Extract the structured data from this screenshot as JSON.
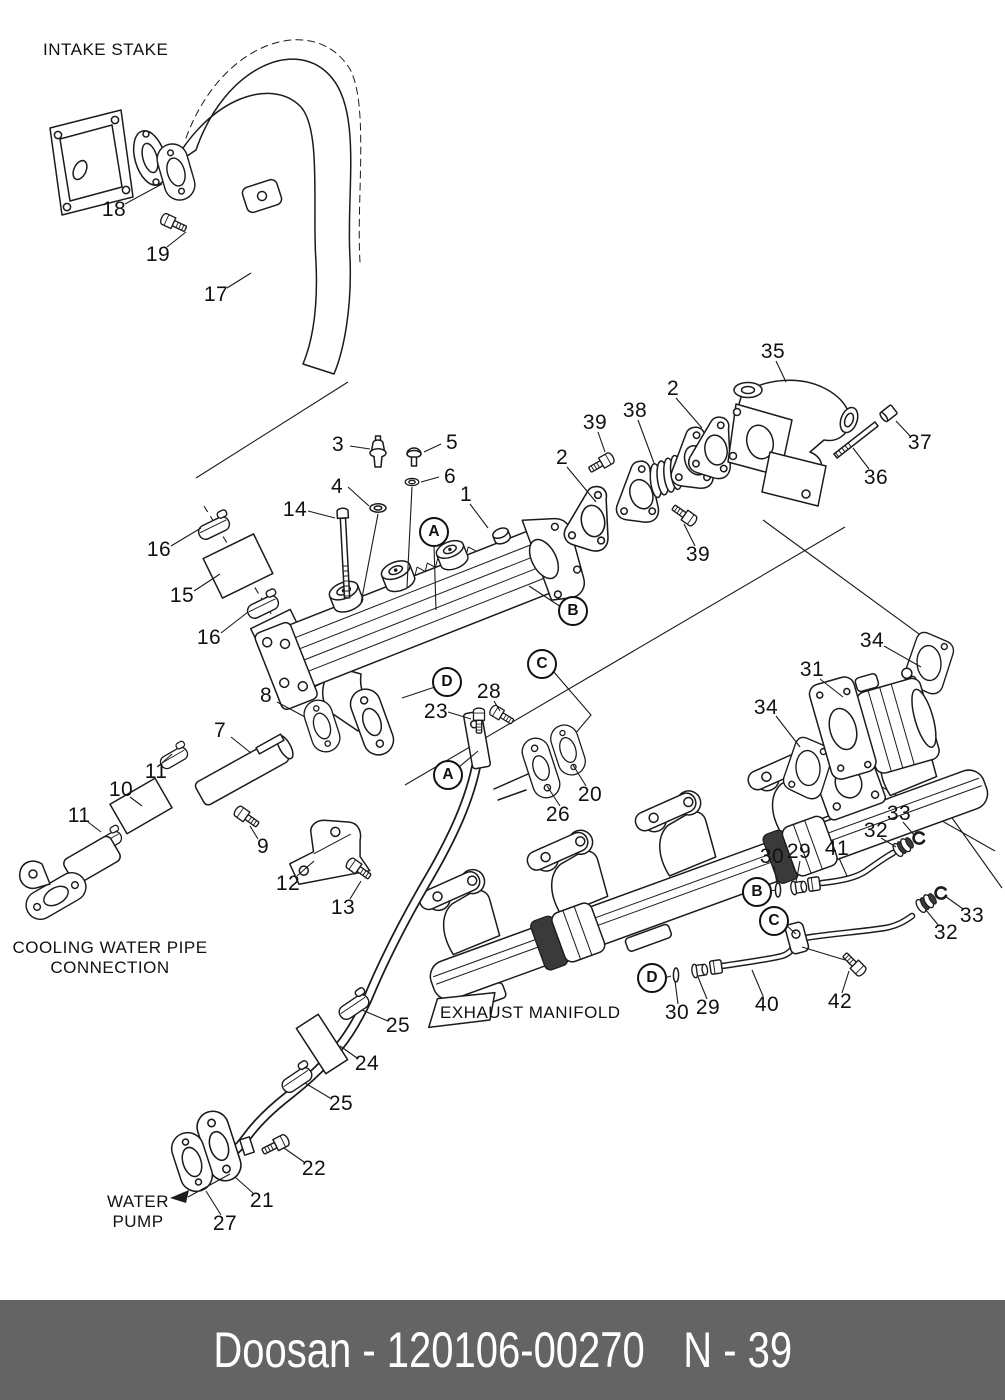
{
  "colors": {
    "background": "#ffffff",
    "line": "#1b1b1b",
    "footer_background": "#646464",
    "footer_text": "#ffffff"
  },
  "diagram": {
    "section_labels": [
      {
        "id": "intake-stake",
        "lines": [
          "INTAKE STAKE"
        ],
        "x": 43,
        "y": 40,
        "align": "left"
      },
      {
        "id": "cooling-water-pipe-connection",
        "lines": [
          "COOLING WATER PIPE",
          "CONNECTION"
        ],
        "x": 110,
        "y": 938,
        "align": "center"
      },
      {
        "id": "exhaust-manifold",
        "lines": [
          "EXHAUST MANIFOLD"
        ],
        "x": 440,
        "y": 1003,
        "align": "left"
      },
      {
        "id": "water-pump",
        "lines": [
          "WATER",
          "PUMP"
        ],
        "x": 138,
        "y": 1192,
        "align": "center"
      }
    ],
    "callouts": [
      {
        "label": "18",
        "x": 114,
        "y": 210,
        "shape": "plain"
      },
      {
        "label": "19",
        "x": 158,
        "y": 255,
        "shape": "plain"
      },
      {
        "label": "17",
        "x": 216,
        "y": 295,
        "shape": "plain"
      },
      {
        "label": "3",
        "x": 338,
        "y": 445,
        "shape": "plain"
      },
      {
        "label": "5",
        "x": 452,
        "y": 443,
        "shape": "plain"
      },
      {
        "label": "4",
        "x": 337,
        "y": 487,
        "shape": "plain"
      },
      {
        "label": "6",
        "x": 450,
        "y": 477,
        "shape": "plain"
      },
      {
        "label": "1",
        "x": 466,
        "y": 495,
        "shape": "plain"
      },
      {
        "label": "14",
        "x": 295,
        "y": 510,
        "shape": "plain"
      },
      {
        "label": "2",
        "x": 562,
        "y": 458,
        "shape": "plain"
      },
      {
        "label": "39",
        "x": 595,
        "y": 423,
        "shape": "plain"
      },
      {
        "label": "38",
        "x": 635,
        "y": 411,
        "shape": "plain"
      },
      {
        "label": "2",
        "x": 673,
        "y": 389,
        "shape": "plain"
      },
      {
        "label": "35",
        "x": 773,
        "y": 352,
        "shape": "plain"
      },
      {
        "label": "37",
        "x": 920,
        "y": 443,
        "shape": "plain"
      },
      {
        "label": "36",
        "x": 876,
        "y": 478,
        "shape": "plain"
      },
      {
        "label": "39",
        "x": 698,
        "y": 555,
        "shape": "plain"
      },
      {
        "label": "16",
        "x": 159,
        "y": 550,
        "shape": "plain"
      },
      {
        "label": "15",
        "x": 182,
        "y": 596,
        "shape": "plain"
      },
      {
        "label": "16",
        "x": 209,
        "y": 638,
        "shape": "plain"
      },
      {
        "label": "A",
        "x": 434,
        "y": 532,
        "shape": "circled"
      },
      {
        "label": "B",
        "x": 573,
        "y": 611,
        "shape": "circled"
      },
      {
        "label": "C",
        "x": 542,
        "y": 664,
        "shape": "circled"
      },
      {
        "label": "D",
        "x": 447,
        "y": 682,
        "shape": "circled"
      },
      {
        "label": "34",
        "x": 872,
        "y": 641,
        "shape": "plain"
      },
      {
        "label": "31",
        "x": 812,
        "y": 670,
        "shape": "plain"
      },
      {
        "label": "34",
        "x": 766,
        "y": 708,
        "shape": "plain"
      },
      {
        "label": "8",
        "x": 266,
        "y": 696,
        "shape": "plain"
      },
      {
        "label": "23",
        "x": 436,
        "y": 712,
        "shape": "plain"
      },
      {
        "label": "28",
        "x": 489,
        "y": 692,
        "shape": "plain"
      },
      {
        "label": "7",
        "x": 220,
        "y": 731,
        "shape": "plain"
      },
      {
        "label": "A",
        "x": 448,
        "y": 775,
        "shape": "circled"
      },
      {
        "label": "26",
        "x": 558,
        "y": 815,
        "shape": "plain"
      },
      {
        "label": "20",
        "x": 590,
        "y": 795,
        "shape": "plain"
      },
      {
        "label": "11",
        "x": 156,
        "y": 772,
        "shape": "plain"
      },
      {
        "label": "10",
        "x": 121,
        "y": 790,
        "shape": "plain"
      },
      {
        "label": "11",
        "x": 79,
        "y": 816,
        "shape": "plain"
      },
      {
        "label": "9",
        "x": 263,
        "y": 847,
        "shape": "plain"
      },
      {
        "label": "12",
        "x": 288,
        "y": 884,
        "shape": "plain"
      },
      {
        "label": "13",
        "x": 343,
        "y": 908,
        "shape": "plain"
      },
      {
        "label": "33",
        "x": 899,
        "y": 814,
        "shape": "plain"
      },
      {
        "label": "32",
        "x": 876,
        "y": 831,
        "shape": "plain"
      },
      {
        "label": "30",
        "x": 772,
        "y": 857,
        "shape": "plain"
      },
      {
        "label": "29",
        "x": 799,
        "y": 852,
        "shape": "plain"
      },
      {
        "label": "41",
        "x": 837,
        "y": 849,
        "shape": "plain"
      },
      {
        "label": "B",
        "x": 757,
        "y": 892,
        "shape": "circled"
      },
      {
        "label": "C",
        "x": 774,
        "y": 921,
        "shape": "circled"
      },
      {
        "label": "33",
        "x": 972,
        "y": 916,
        "shape": "plain"
      },
      {
        "label": "32",
        "x": 946,
        "y": 933,
        "shape": "plain"
      },
      {
        "label": "D",
        "x": 652,
        "y": 978,
        "shape": "circled"
      },
      {
        "label": "30",
        "x": 677,
        "y": 1013,
        "shape": "plain"
      },
      {
        "label": "29",
        "x": 708,
        "y": 1008,
        "shape": "plain"
      },
      {
        "label": "40",
        "x": 767,
        "y": 1005,
        "shape": "plain"
      },
      {
        "label": "42",
        "x": 840,
        "y": 1002,
        "shape": "plain"
      },
      {
        "label": "25",
        "x": 398,
        "y": 1026,
        "shape": "plain"
      },
      {
        "label": "24",
        "x": 367,
        "y": 1064,
        "shape": "plain"
      },
      {
        "label": "25",
        "x": 341,
        "y": 1104,
        "shape": "plain"
      },
      {
        "label": "22",
        "x": 314,
        "y": 1169,
        "shape": "plain"
      },
      {
        "label": "21",
        "x": 262,
        "y": 1201,
        "shape": "plain"
      },
      {
        "label": "27",
        "x": 225,
        "y": 1224,
        "shape": "plain"
      }
    ]
  },
  "footer": {
    "brand_part": "Doosan - 120106-00270",
    "page_ref": "N - 39"
  }
}
